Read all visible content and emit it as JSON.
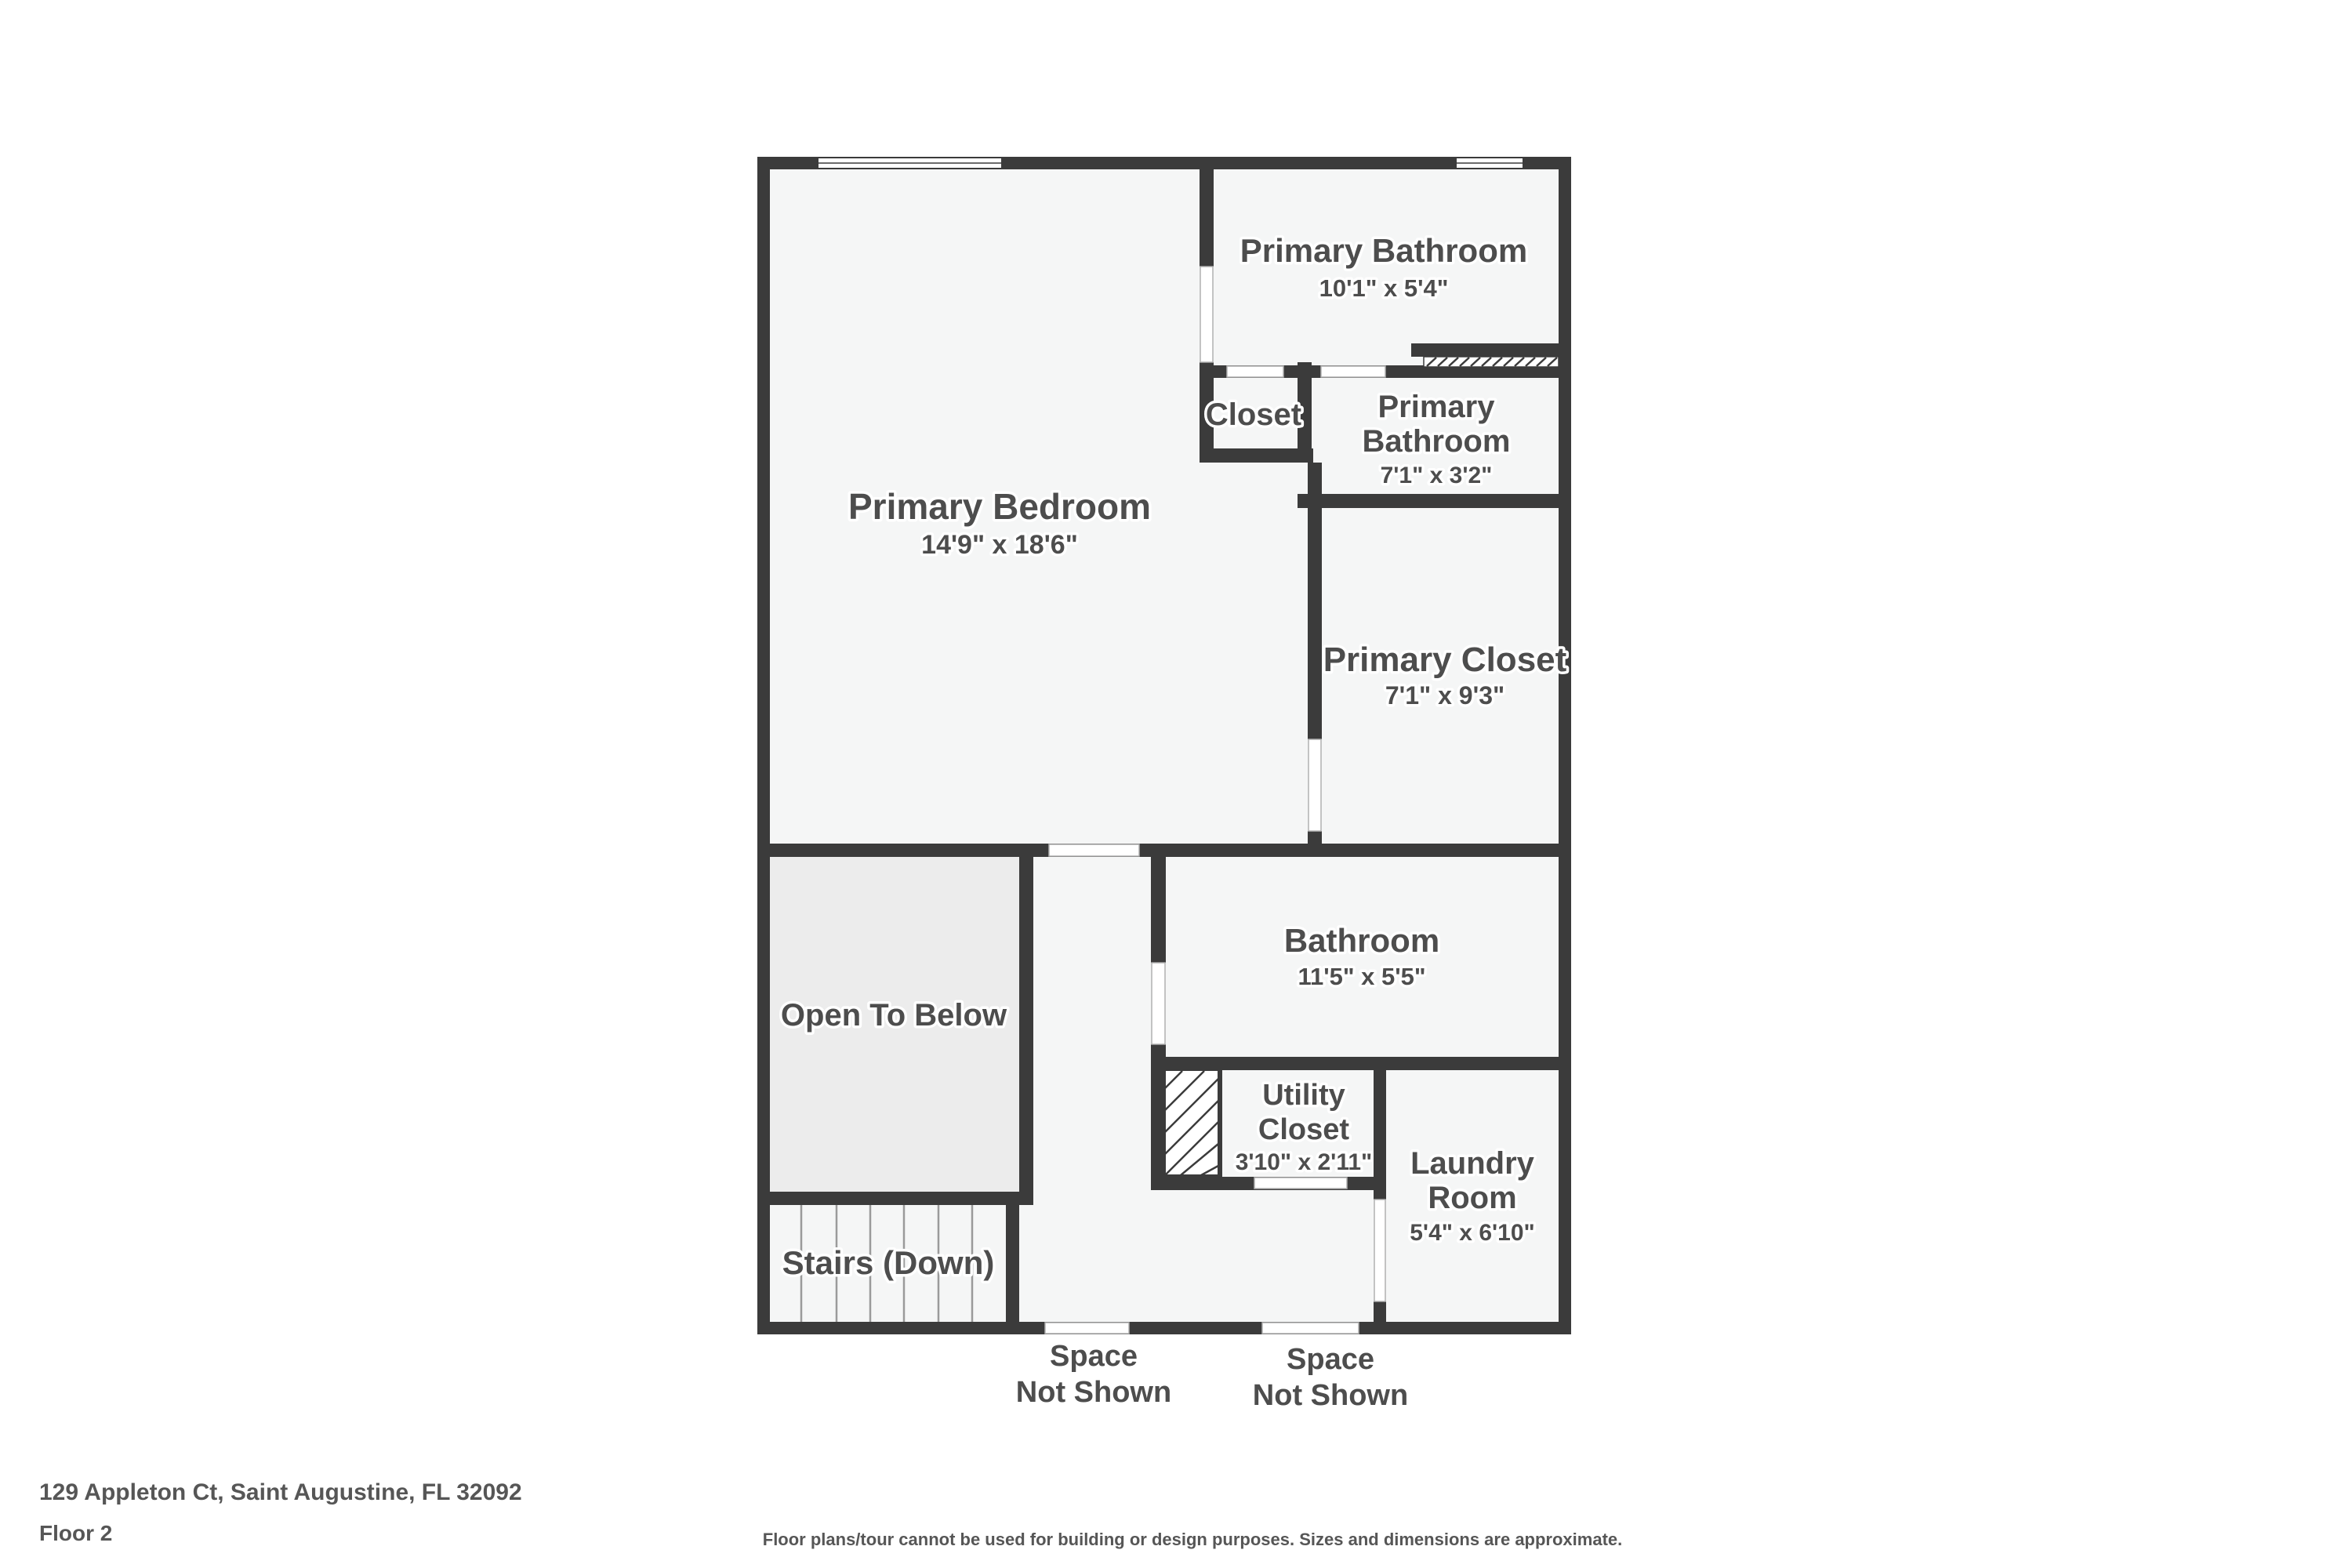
{
  "page": {
    "address": "129 Appleton Ct, Saint Augustine, FL 32092",
    "floor_label": "Floor 2",
    "disclaimer": "Floor plans/tour cannot be used for building or design purposes. Sizes and dimensions are approximate."
  },
  "colors": {
    "wall": "#3b3b3b",
    "room_fill": "#f5f6f6",
    "open_to_below_fill": "#ececec",
    "label_text": "#4d4d4d",
    "footer_text": "#565656"
  },
  "rooms": {
    "primary_bathroom_1": {
      "name": "Primary Bathroom",
      "dims": "10'1\" x 5'4\""
    },
    "closet": {
      "name": "Closet"
    },
    "primary_bathroom_2": {
      "name_line1": "Primary",
      "name_line2": "Bathroom",
      "dims": "7'1\" x 3'2\""
    },
    "primary_bedroom": {
      "name": "Primary Bedroom",
      "dims": "14'9\" x 18'6\""
    },
    "primary_closet": {
      "name": "Primary Closet",
      "dims": "7'1\" x 9'3\""
    },
    "open_to_below": {
      "name": "Open To Below"
    },
    "bathroom": {
      "name": "Bathroom",
      "dims": "11'5\" x 5'5\""
    },
    "utility_closet": {
      "name_line1": "Utility",
      "name_line2": "Closet",
      "dims": "3'10\" x 2'11\""
    },
    "laundry_room": {
      "name_line1": "Laundry",
      "name_line2": "Room",
      "dims": "5'4\" x 6'10\""
    },
    "stairs": {
      "name": "Stairs (Down)"
    },
    "space_not_shown_1": {
      "name_line1": "Space",
      "name_line2": "Not Shown"
    },
    "space_not_shown_2": {
      "name_line1": "Space",
      "name_line2": "Not Shown"
    }
  }
}
